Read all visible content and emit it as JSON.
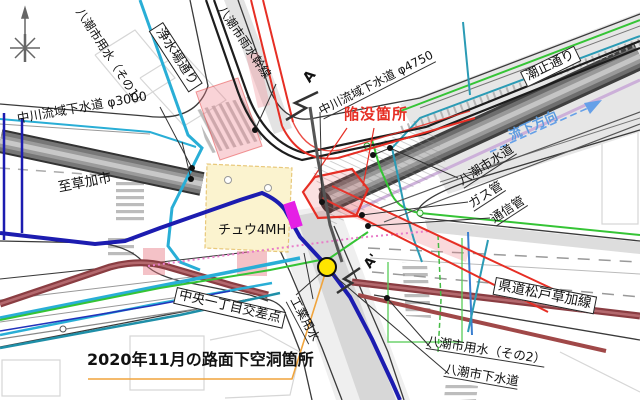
{
  "map": {
    "description": "utility-plan-of-intersection",
    "labels": {
      "yosui1": "八潮市用水（その1）",
      "josuijo_dori": "浄水場通り",
      "usui_kansen": "八潮市雨水幹線",
      "nakagawa_4750": "中川流域下水道 φ4750",
      "shiodome_dori": "潮止通り",
      "kanbotsu": "陥没箇所",
      "ryuka_hoko": "流下方向",
      "nakagawa_3000": "中川流域下水道 φ3000",
      "itaru_soka": "至草加市",
      "yashio_suido": "八潮市水道",
      "gas_kan": "ガス管",
      "tsushin_kan": "通信管",
      "kendo_matsudo_soka": "県道松戸草加線",
      "yosui2": "八潮市用水（その2）",
      "yashio_gesui": "八潮市下水道",
      "chu4mh": "チュウ4MH",
      "chuo_kosaten": "中央一丁目交差点",
      "kogyo_yosui": "工業用水",
      "cavity_2020": "2020年11月の路面下空洞箇所",
      "section_a": "A",
      "section_a_prime": "A'"
    },
    "colors": {
      "collapse_red": "#e62e24",
      "flow_arrow_blue": "#5b9be0",
      "cavity_marker_yellow": "#ffe500",
      "leader_orange": "#f0a43c",
      "water_cyan": "#29aed6",
      "sewer_maroon": "#8a3d42",
      "irrigation_green": "#35c435",
      "trunk_navy": "#1c1cb0",
      "structure_magenta": "#e520e5"
    }
  }
}
